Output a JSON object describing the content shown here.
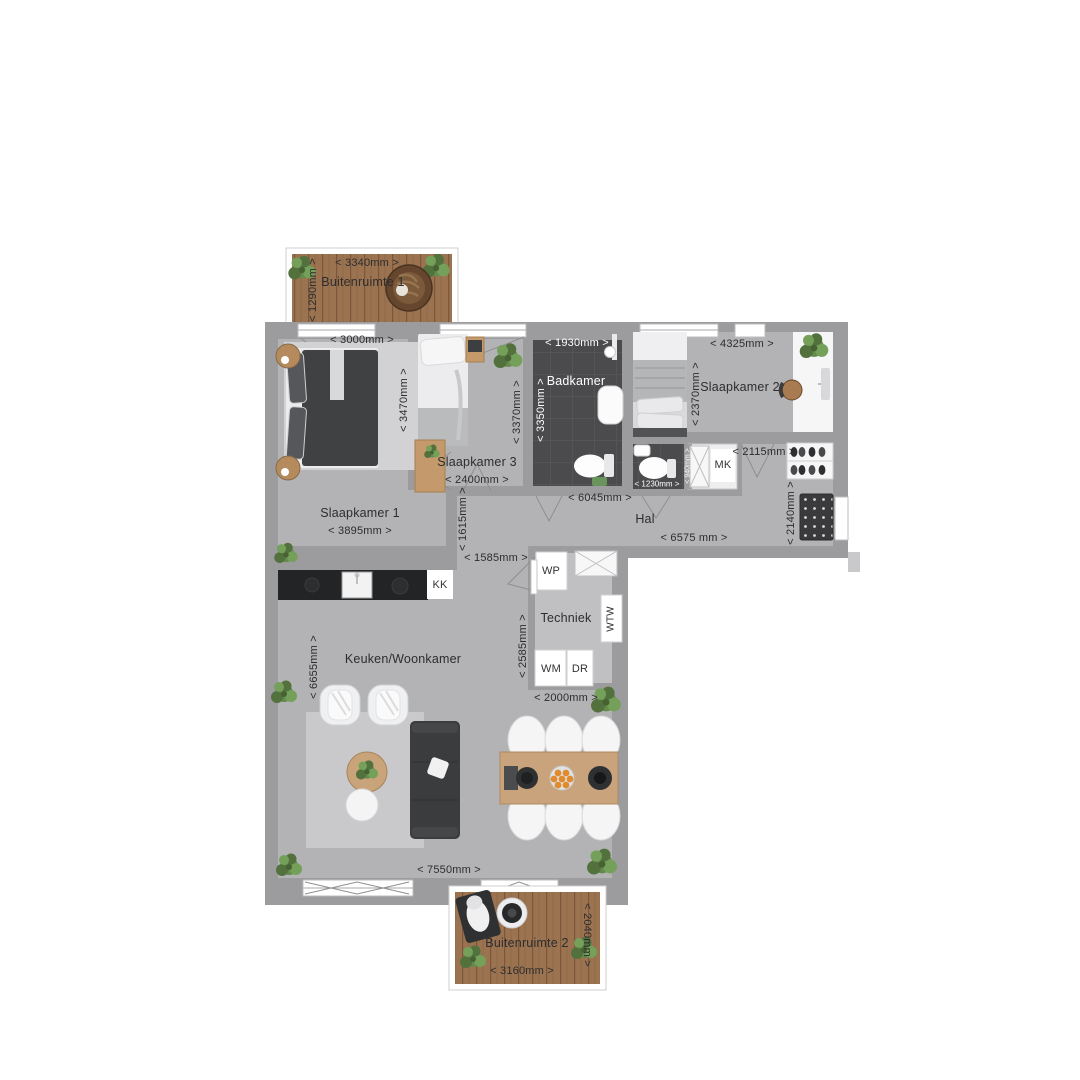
{
  "colors": {
    "wall": "#9c9c9f",
    "floor": "#b3b3b5",
    "tech_floor": "#c0c0c2",
    "bath_tile": "#4b4b4d",
    "wood_deck": "#9b7350",
    "counter": "#232425",
    "sofa": "#3a3c3e",
    "plant_green": "#648a4e",
    "text": "#2d2d2f"
  },
  "rooms": {
    "buitenruimte1": {
      "name": "Buitenruimte 1",
      "width": "< 3340mm >",
      "depth": "< 1290mm >"
    },
    "slaapkamer1": {
      "name": "Slaapkamer 1",
      "width_top": "< 3000mm >",
      "height": "< 3470mm >",
      "width_bottom": "< 3895mm >"
    },
    "slaapkamer3": {
      "name": "Slaapkamer 3",
      "width": "< 2400mm >",
      "height": "< 3370mm >"
    },
    "badkamer": {
      "name": "Badkamer",
      "width": "< 1930mm >",
      "height": "< 3350mm >"
    },
    "slaapkamer2": {
      "name": "Slaapkamer 2",
      "width": "< 4325mm >",
      "height": "< 2370mm >"
    },
    "wc": {
      "width": "< 1230mm >",
      "height": "< 940mm >"
    },
    "hal": {
      "name": "Hal",
      "dim_upper": "< 6045mm >",
      "dim_lower": "< 6575 mm >",
      "dim_entry": "< 2140mm >",
      "dim_closet": "< 2115mm >",
      "dim_leg": "< 1615mm >",
      "dim_passage": "< 1585mm >",
      "closet_label": "MK"
    },
    "keuken": {
      "name": "Keuken/Woonkamer",
      "height": "< 6655mm >",
      "width": "< 7550mm >",
      "kitchenette_label": "KK"
    },
    "techniek": {
      "name": "Techniek",
      "heatpump_label": "WP",
      "ventilation_label": "WTW",
      "washer_label": "WM",
      "dryer_label": "DR",
      "height": "< 2585mm >",
      "width": "< 2000mm >"
    },
    "buitenruimte2": {
      "name": "Buitenruimte 2",
      "width": "< 3160mm >",
      "depth": "< 2040mm >"
    }
  }
}
